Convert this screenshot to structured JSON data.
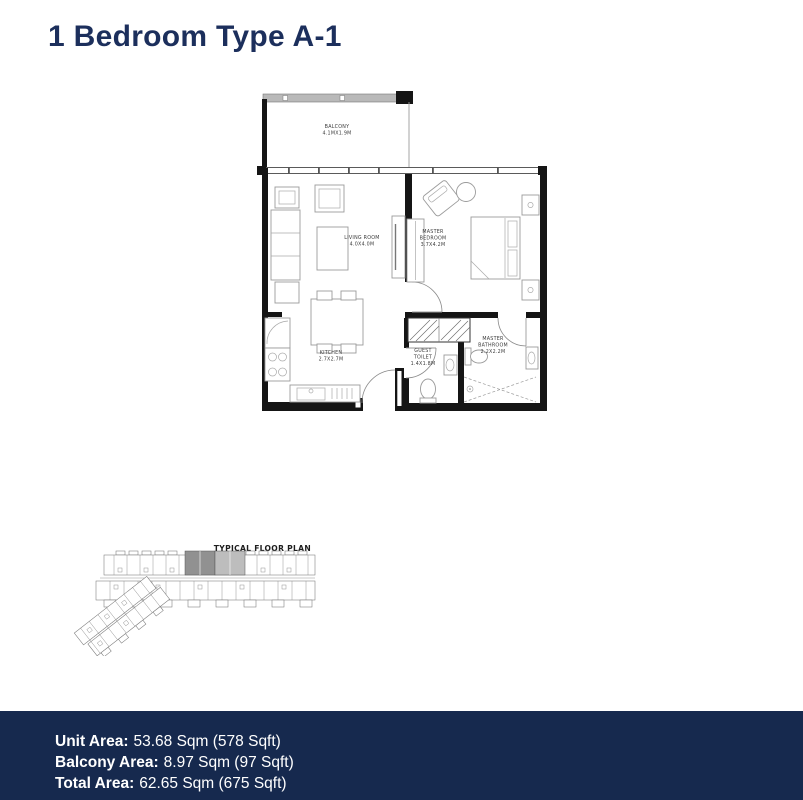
{
  "page": {
    "title": "1 Bedroom Type A-1"
  },
  "colors": {
    "navy_footer": "#16294e",
    "navy_title": "#1c2f5c",
    "wall_black": "#151515",
    "drawing_gray": "#9b9b9b",
    "highlight_dark": "#919191",
    "highlight_light": "#bdbdbd"
  },
  "floor_plan": {
    "rooms": [
      {
        "id": "balcony",
        "label_lines": [
          "BALCONY",
          "4.1MX1.9M"
        ]
      },
      {
        "id": "living-room",
        "label_lines": [
          "LIVING ROOM",
          "4.0X4.0M"
        ]
      },
      {
        "id": "master-bedroom",
        "label_lines": [
          "MASTER",
          "BEDROOM",
          "3.7X4.2M"
        ]
      },
      {
        "id": "kitchen",
        "label_lines": [
          "KITCHEN",
          "2.7X2.7M"
        ]
      },
      {
        "id": "guest-toilet",
        "label_lines": [
          "GUEST",
          "TOILET",
          "1.4X1.8M"
        ]
      },
      {
        "id": "master-bathroom",
        "label_lines": [
          "MASTER",
          "BATHROOM",
          "2.2X2.2M"
        ]
      }
    ]
  },
  "mini_plan": {
    "label": "TYPICAL FLOOR PLAN"
  },
  "footer": {
    "rows": [
      {
        "label": "Unit Area:",
        "value": "53.68 Sqm (578 Sqft)"
      },
      {
        "label": "Balcony Area:",
        "value": "8.97 Sqm (97 Sqft)"
      },
      {
        "label": "Total Area:",
        "value": "62.65 Sqm (675 Sqft)"
      }
    ]
  }
}
